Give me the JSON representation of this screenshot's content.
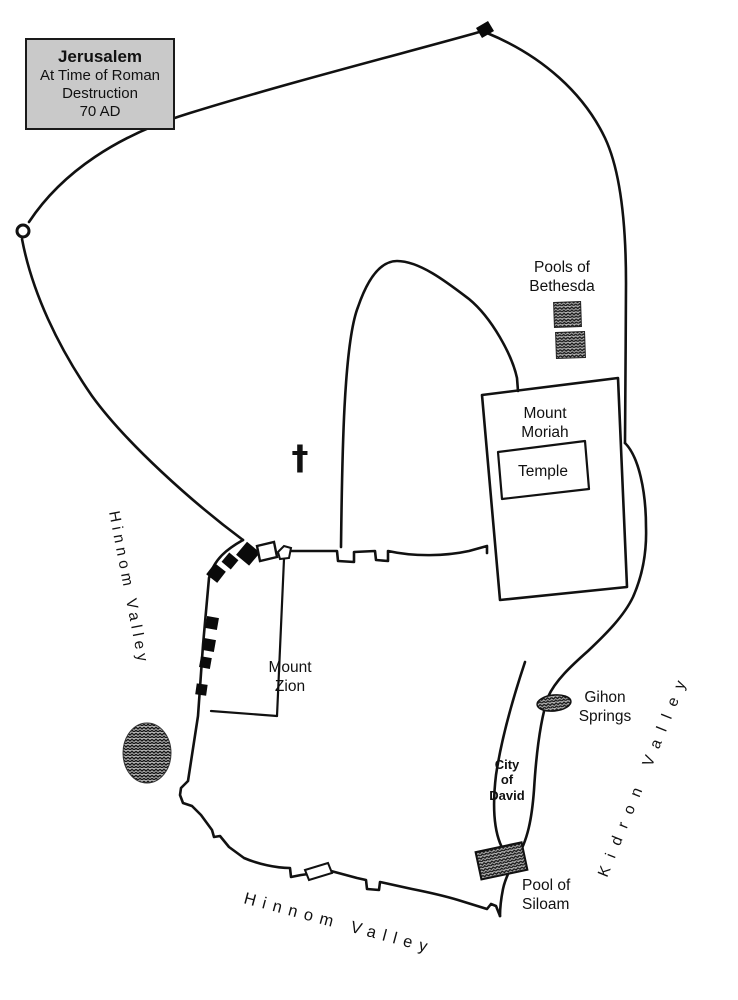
{
  "title_box": {
    "title": "Jerusalem",
    "subtitle_line1": "At Time of Roman",
    "subtitle_line2": "Destruction",
    "subtitle_line3": "70 AD"
  },
  "map": {
    "labels": {
      "pools_bethesda_line1": "Pools of",
      "pools_bethesda_line2": "Bethesda",
      "mount_moriah_line1": "Mount",
      "mount_moriah_line2": "Moriah",
      "temple": "Temple",
      "mount_zion_line1": "Mount",
      "mount_zion_line2": "Zion",
      "gihon_line1": "Gihon",
      "gihon_line2": "Springs",
      "city_of_david_line1": "City",
      "city_of_david_line2": "of",
      "city_of_david_line3": "David",
      "pool_siloam_line1": "Pool of",
      "pool_siloam_line2": "Siloam",
      "hinnom_valley_west": "Hinnom Valley",
      "hinnom_valley_south": "Hinnom Valley",
      "kidron_valley": "Kidron Valley",
      "church_cross_symbol": "†"
    },
    "colors": {
      "ink": "#111111",
      "title_box_fill": "#c9c9c9",
      "hatch_base": "#b3b3b3",
      "hatch_line": "#141414",
      "background": "#ffffff"
    }
  }
}
